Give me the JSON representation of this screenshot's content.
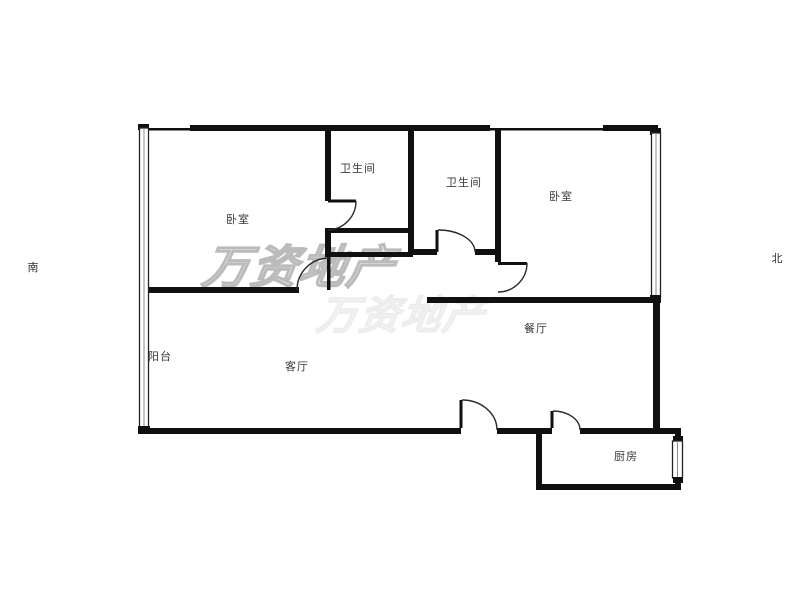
{
  "floor_plan": {
    "rooms": [
      {
        "name": "bedroom-1",
        "label": "卧室"
      },
      {
        "name": "bathroom-1",
        "label": "卫生间"
      },
      {
        "name": "bathroom-2",
        "label": "卫生间"
      },
      {
        "name": "bedroom-2",
        "label": "卧室"
      },
      {
        "name": "dining-room",
        "label": "餐厅"
      },
      {
        "name": "living-room",
        "label": "客厅"
      },
      {
        "name": "balcony",
        "label": "阳台"
      },
      {
        "name": "kitchen",
        "label": "厨房"
      }
    ],
    "compass": {
      "south_label": "南",
      "north_label": "北"
    },
    "watermark": {
      "text": "万资地产",
      "color": "#b4b4b4"
    },
    "colors": {
      "wall": "#101010",
      "door_line": "#2a2a2a",
      "label_text": "#3a3a3a",
      "background": "#ffffff"
    }
  }
}
